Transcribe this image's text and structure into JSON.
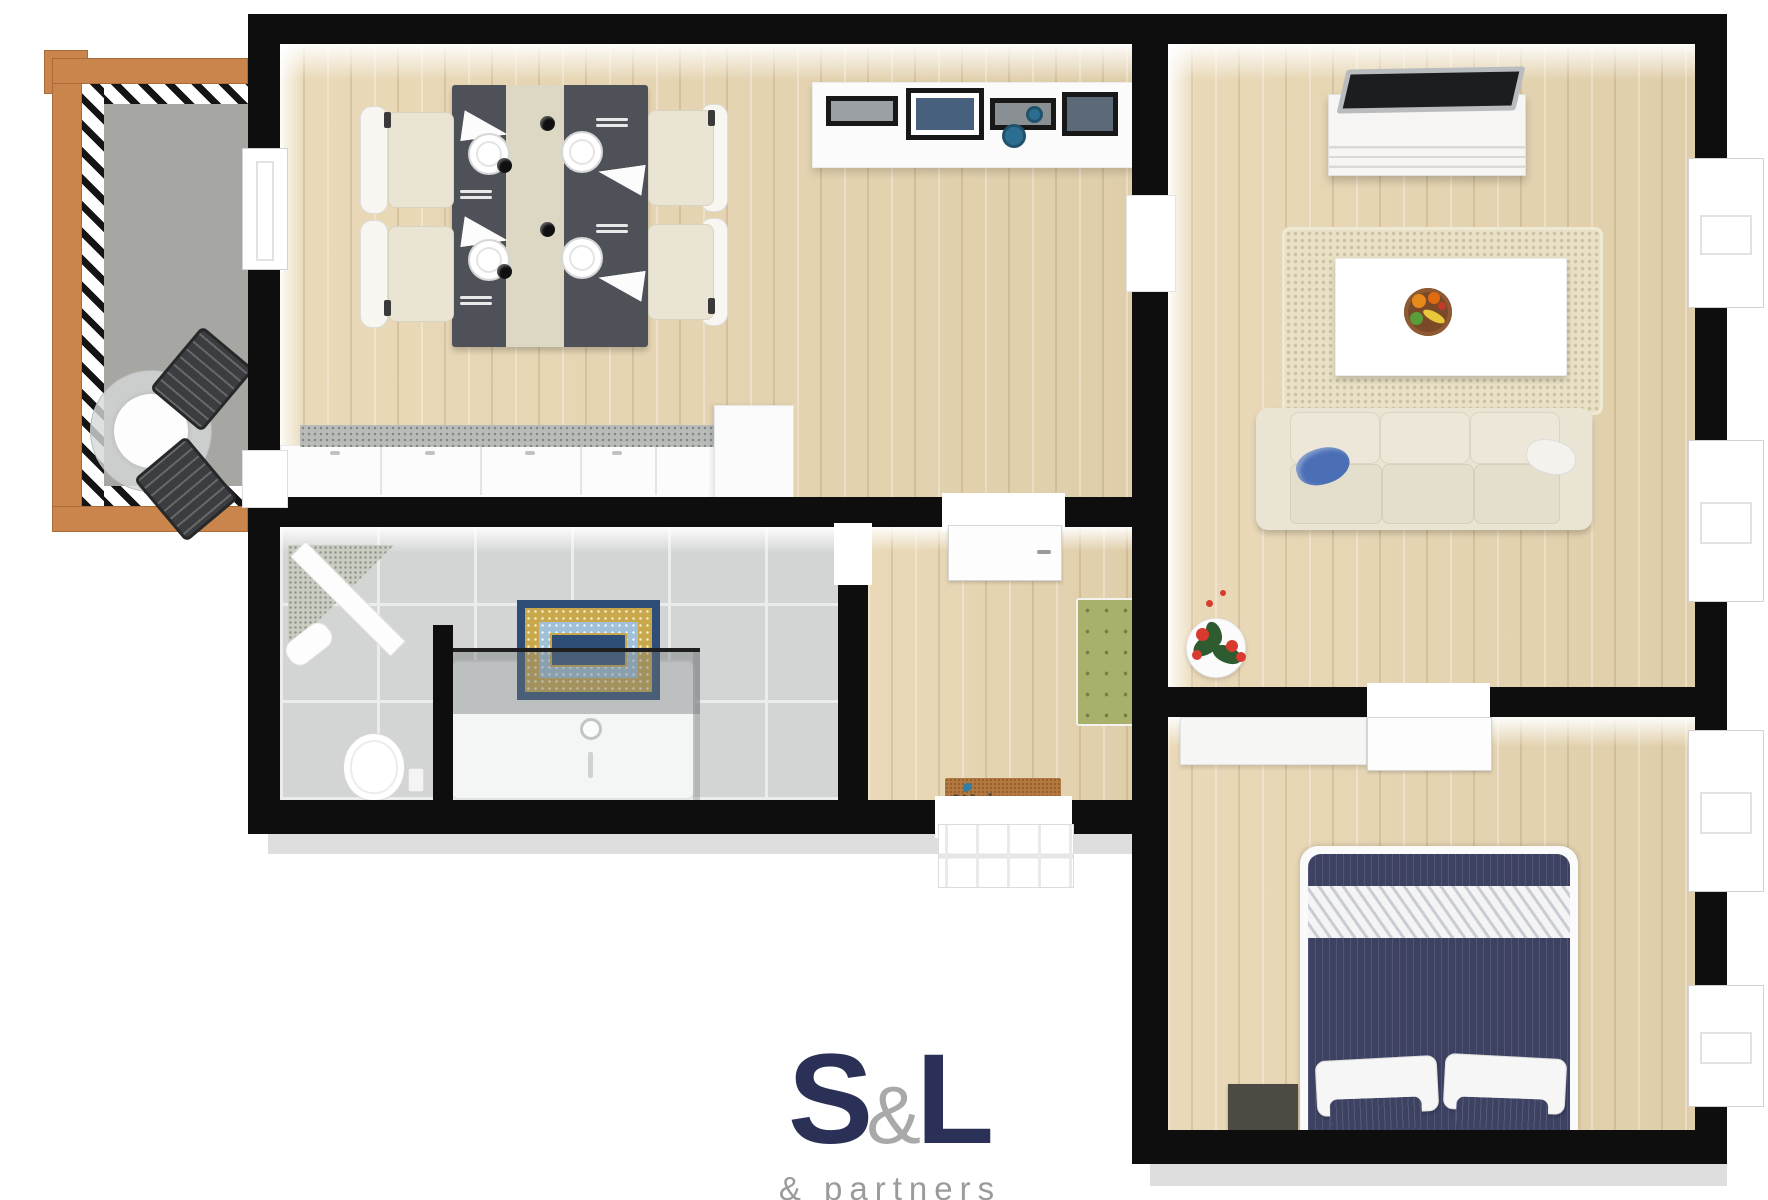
{
  "logo": {
    "s": "S",
    "amp": "&",
    "l": "L",
    "subtitle": "& partners"
  },
  "welcome_mat": {
    "text": "Welcome"
  },
  "colors": {
    "wall": "#0e0e0e",
    "wood": "#e7d5b0",
    "tile": "#d3d5d4",
    "balconyWood": "#c9854b",
    "balconyFloor": "#a6a6a3",
    "navy": "#3d4263",
    "cream": "#e9e4d3",
    "tableDark": "#4e5157",
    "runner": "#ddd8c4",
    "rug": "#e9e1c6",
    "benchGreen": "#a9b06c",
    "matBrown": "#b5793f",
    "matNavy": "#2e4e78",
    "matGold": "#c9a84c",
    "matBlue": "#9fc0d8",
    "bowlBlue": "#2c6e8f",
    "pillowBlue": "#4a6fb5",
    "flowerRed": "#d83a30",
    "leafGreen": "#2e5c30",
    "logoNavy": "#2b3156",
    "logoGray": "#a9a9a9"
  }
}
